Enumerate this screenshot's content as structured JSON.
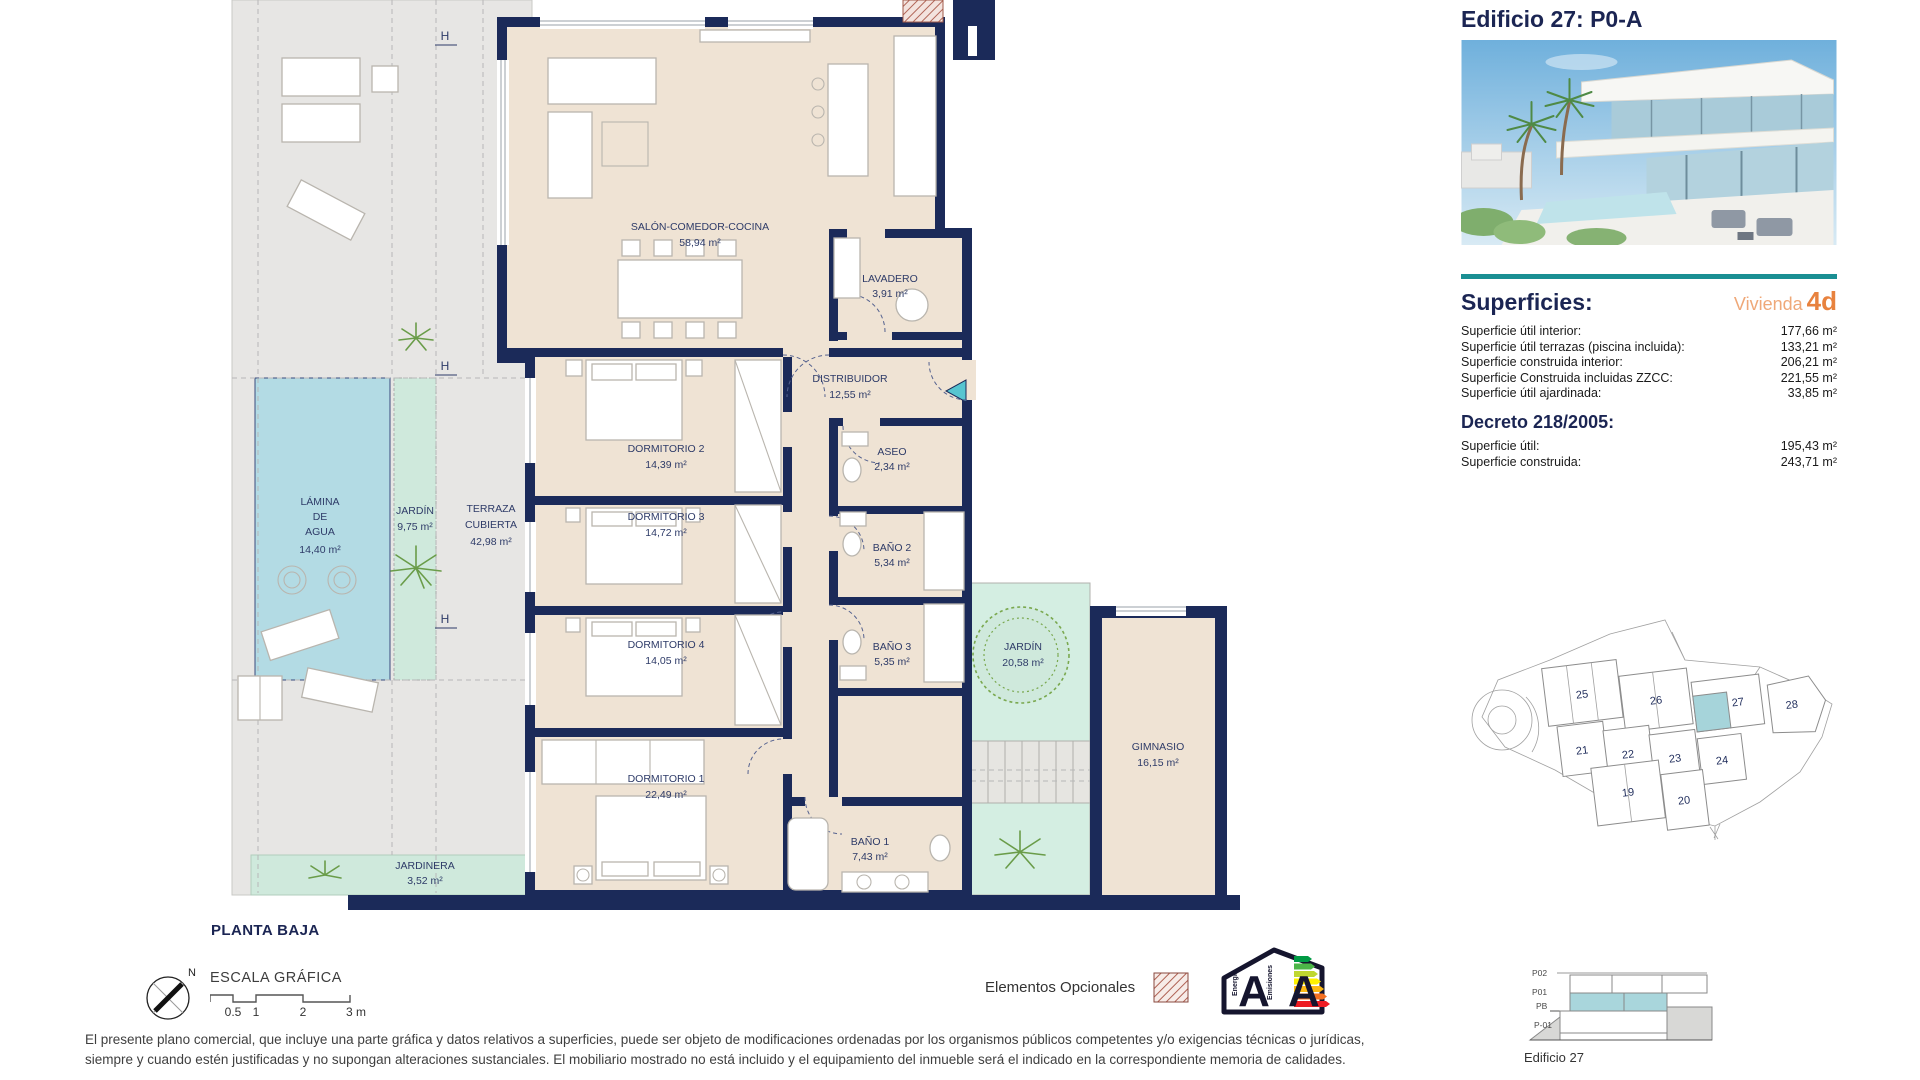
{
  "header": {
    "title": "Edificio 27: P0-A"
  },
  "superficies": {
    "heading": "Superficies:",
    "vivienda_label": "Vivienda",
    "vivienda_value": "4d",
    "rows": [
      {
        "label": "Superficie útil interior:",
        "value": "177,66 m²"
      },
      {
        "label": "Superficie útil terrazas (piscina incluida):",
        "value": "133,21 m²"
      },
      {
        "label": "Superficie construida interior:",
        "value": "206,21 m²"
      },
      {
        "label": "Superficie Construida incluidas ZZCC:",
        "value": "221,55 m²"
      },
      {
        "label": "Superficie útil ajardinada:",
        "value": "33,85 m²"
      }
    ]
  },
  "decreto": {
    "heading": "Decreto 218/2005:",
    "rows": [
      {
        "label": "Superficie útil:",
        "value": "195,43 m²"
      },
      {
        "label": "Superficie construida:",
        "value": "243,71 m²"
      }
    ]
  },
  "plan": {
    "floor_label": "PLANTA BAJA",
    "north": "N",
    "section_marker": "H",
    "rooms": {
      "salon": {
        "name": "SALÓN-COMEDOR-COCINA",
        "area": "58,94 m²"
      },
      "lavadero": {
        "name": "LAVADERO",
        "area": "3,91 m²"
      },
      "distribuidor": {
        "name": "DISTRIBUIDOR",
        "area": "12,55 m²"
      },
      "dormitorio2": {
        "name": "DORMITORIO 2",
        "area": "14,39 m²"
      },
      "aseo": {
        "name": "ASEO",
        "area": "2,34 m²"
      },
      "dormitorio3": {
        "name": "DORMITORIO 3",
        "area": "14,72 m²"
      },
      "bano2": {
        "name": "BAÑO 2",
        "area": "5,34 m²"
      },
      "dormitorio4": {
        "name": "DORMITORIO 4",
        "area": "14,05 m²"
      },
      "bano3": {
        "name": "BAÑO 3",
        "area": "5,35 m²"
      },
      "dormitorio1": {
        "name": "DORMITORIO 1",
        "area": "22,49 m²"
      },
      "bano1": {
        "name": "BAÑO 1",
        "area": "7,43 m²"
      },
      "jardin_patio": {
        "name": "JARDÍN",
        "area": "20,58 m²"
      },
      "gimnasio": {
        "name": "GIMNASIO",
        "area": "16,15 m²"
      },
      "lamina": {
        "l1": "LÁMINA",
        "l2": "DE",
        "l3": "AGUA",
        "area": "14,40 m²"
      },
      "jardin_lateral": {
        "name": "JARDÍN",
        "area": "9,75 m²"
      },
      "terraza": {
        "l1": "TERRAZA",
        "l2": "CUBIERTA",
        "area": "42,98 m²"
      },
      "jardinera": {
        "name": "JARDINERA",
        "area": "3,52 m²"
      }
    }
  },
  "scale_bar": {
    "title": "ESCALA GRÁFICA",
    "ticks": [
      "0.5",
      "1",
      "2",
      "3 m"
    ]
  },
  "legend": {
    "optional": "Elementos Opcionales"
  },
  "energy": {
    "letter_energy": "A",
    "letter_emissions": "A",
    "caption_energy": "Energía",
    "caption_emissions": "Emisiones"
  },
  "site_plan": {
    "buildings": [
      "19",
      "20",
      "21",
      "22",
      "23",
      "24",
      "25",
      "26",
      "27",
      "28"
    ],
    "highlighted": "27"
  },
  "section_diagram": {
    "levels": [
      "P02",
      "P01",
      "PB",
      "P-01"
    ],
    "caption": "Edificio 27"
  },
  "disclaimer": {
    "line1": "El presente plano comercial, que incluye una parte gráfica y datos relativos a superficies, puede ser objeto de modificaciones ordenadas por los organismos públicos competentes y/o exigencias técnicas o jurídicas,",
    "line2": "siempre y cuando estén justificadas y no supongan alteraciones sustanciales. El mobiliario mostrado no está incluido y el equipamiento del inmueble será el indicado en la correspondiente memoria de calidades."
  },
  "colors": {
    "navy": "#1b2553",
    "wall": "#1b2a59",
    "teal": "#1a8f93",
    "orange": "#e8823e",
    "orange_light": "#efa878",
    "interior": "#efe3d4",
    "outdoor": "#e7e6e4",
    "mint": "#cfe9dc",
    "pool": "#b3dbe4",
    "highlight": "#a6d4da",
    "hatch": "#b06355"
  }
}
